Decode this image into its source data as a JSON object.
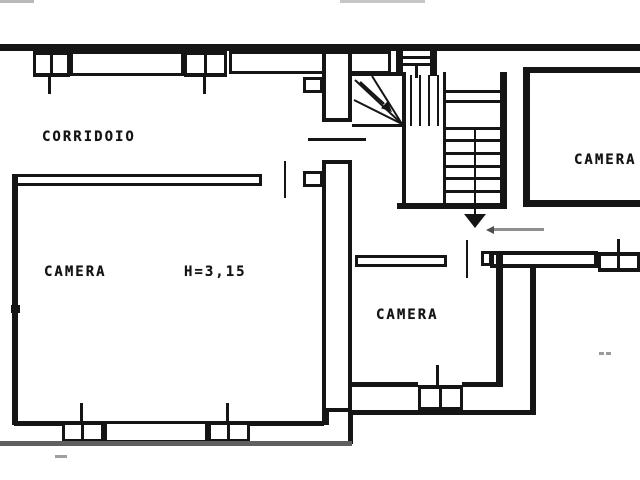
{
  "plan": {
    "type": "scanned floor plan",
    "labels": {
      "corridor": "CORRIDOIO",
      "room_left": "CAMERA",
      "room_left_height": "H=3,15",
      "room_middle": "CAMERA",
      "room_right": "CAMERA"
    },
    "stair": {
      "direction_arrow": "down"
    },
    "colors": {
      "ink": "#151515",
      "muted_gray": "#8f8f8f",
      "exterior_gray": "#5f5f5f",
      "background": "#ffffff"
    }
  }
}
